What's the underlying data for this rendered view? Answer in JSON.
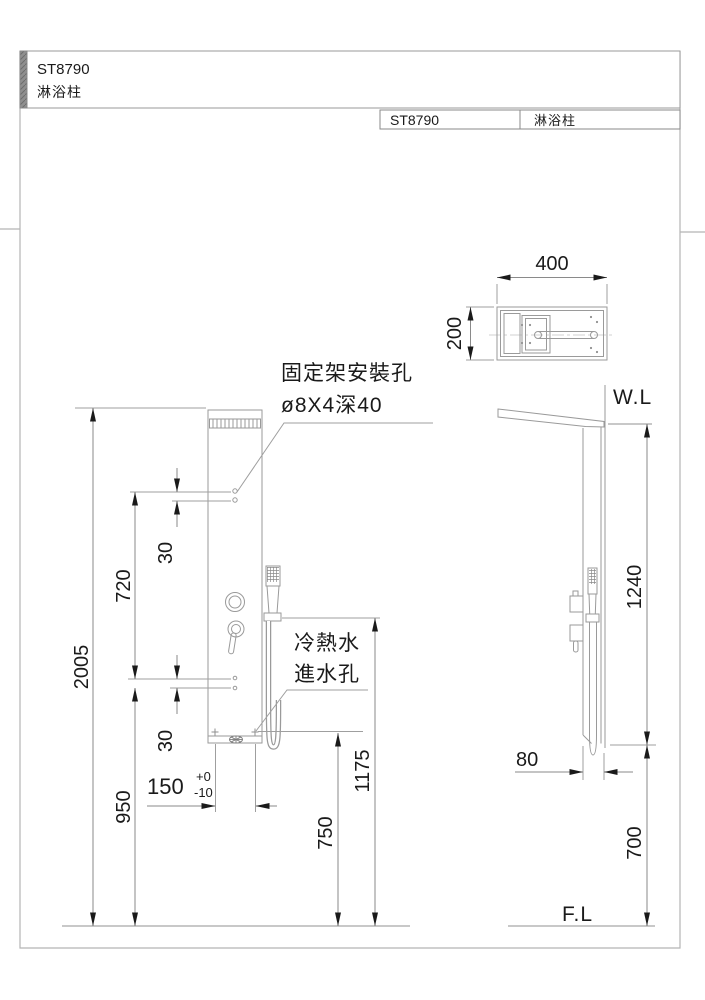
{
  "header": {
    "model": "ST8790",
    "product": "淋浴柱"
  },
  "title_block": {
    "model": "ST8790",
    "product": "淋浴柱"
  },
  "annotations": {
    "mount_hole_title": "固定架安裝孔",
    "mount_hole_spec": "ø8X4深40",
    "inlet_line1": "冷熱水",
    "inlet_line2": "進水孔",
    "water_level": "W.L",
    "floor_level": "F.L"
  },
  "dimensions": {
    "top_width": "400",
    "top_depth": "200",
    "total_height": "2005",
    "hole_span": "720",
    "hole_gap_top": "30",
    "hole_gap_bottom": "30",
    "lower_section": "950",
    "inlet_spacing": "150",
    "inlet_tol_plus": "+0",
    "inlet_tol_minus": "-10",
    "inlet_height": "750",
    "hose_height": "1175",
    "upper_height": "1240",
    "panel_depth": "80",
    "lower_height": "700"
  },
  "colors": {
    "line": "#9a9a9a",
    "dimension": "#8a8a8a",
    "text": "#1a1a1a",
    "frame": "#b5b5b5",
    "accent_bar": "#8f8f8f"
  }
}
